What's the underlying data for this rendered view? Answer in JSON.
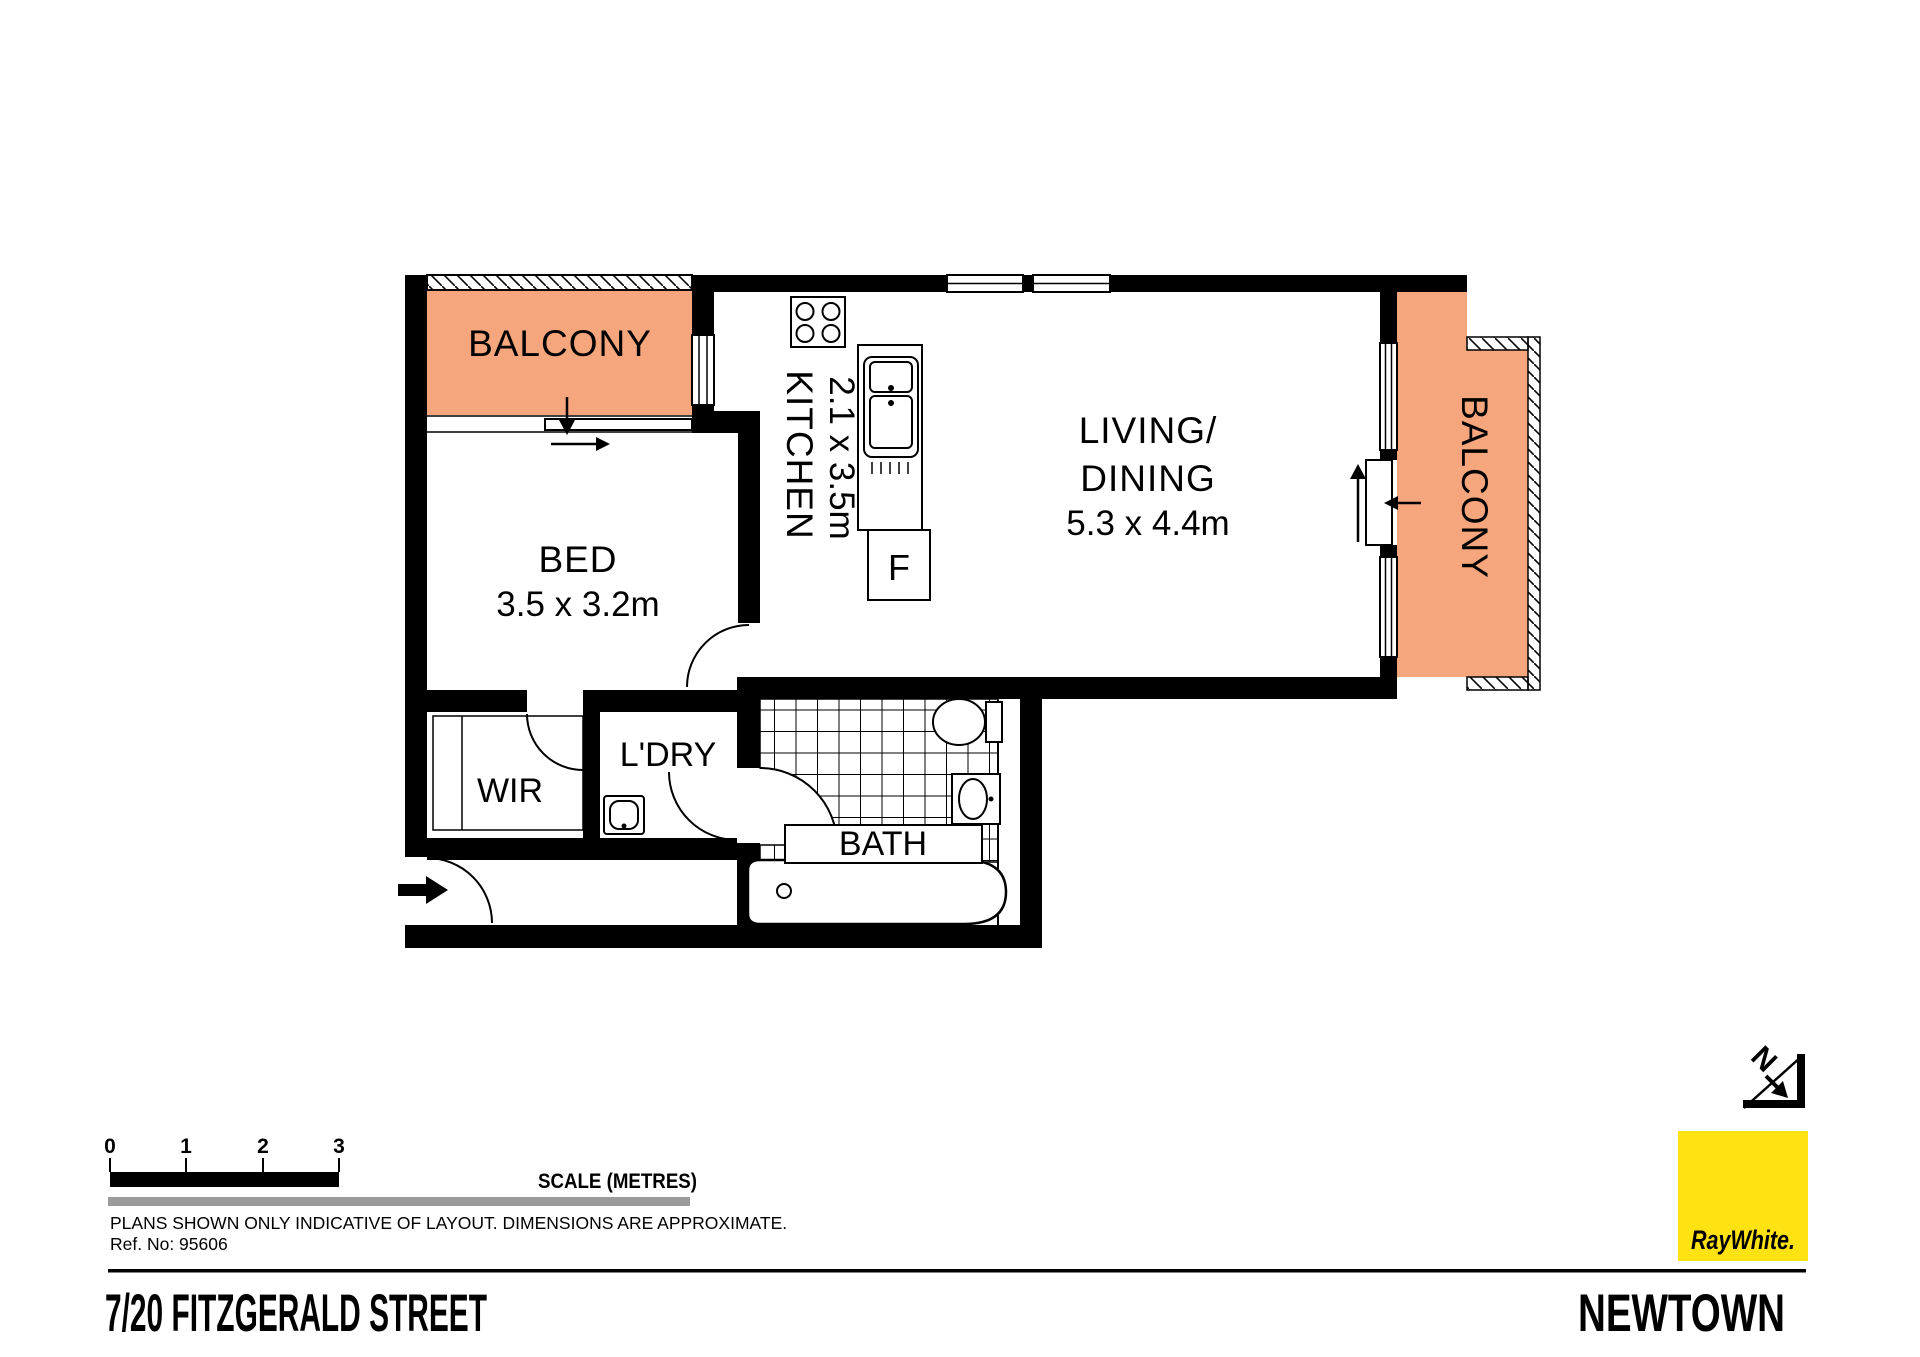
{
  "rooms": {
    "balcony_left": {
      "label": "BALCONY"
    },
    "bed": {
      "label": "BED",
      "dims": "3.5 x 3.2m"
    },
    "kitchen": {
      "label": "KITCHEN",
      "dims": "2.1 x 3.5m"
    },
    "living": {
      "label_line1": "LIVING/",
      "label_line2": "DINING",
      "dims": "5.3 x 4.4m"
    },
    "balcony_right": {
      "label": "BALCONY"
    },
    "wir": {
      "label": "WIR"
    },
    "laundry": {
      "label": "L'DRY"
    },
    "bath": {
      "label": "BATH"
    }
  },
  "fixtures": {
    "fridge_label": "F"
  },
  "north_indicator": {
    "letter": "N"
  },
  "scale_bar": {
    "ticks": [
      "0",
      "1",
      "2",
      "3"
    ],
    "title": "SCALE (METRES)"
  },
  "notes": {
    "disclaimer": "PLANS SHOWN ONLY INDICATIVE OF LAYOUT.  DIMENSIONS ARE APPROXIMATE.",
    "ref": "Ref. No: 95606"
  },
  "footer": {
    "address": "7/20 FITZGERALD STREET",
    "suburb": "NEWTOWN"
  },
  "logo": {
    "brand": "RayWhite.",
    "bg": "#FFE212",
    "fg": "#4D4D55"
  },
  "colors": {
    "balcony": "#F5A67C",
    "wall": "#000000",
    "gray_bar": "#9B9B9B"
  }
}
